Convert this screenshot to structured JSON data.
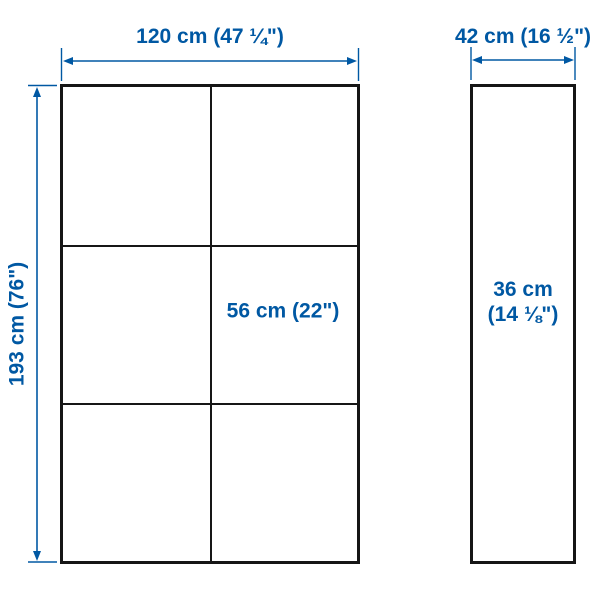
{
  "colors": {
    "dimension_blue": "#0058a3",
    "outline_black": "#161616",
    "background": "#ffffff"
  },
  "diagram": {
    "front_view": {
      "width_label": "120 cm (47 ¼\")",
      "height_label": "193 cm (76\")",
      "compartment_width_label": "56 cm (22\")",
      "grid_columns": 2,
      "grid_rows": 3
    },
    "side_view": {
      "depth_label": "42 cm (16 ½\")",
      "inner_depth_label_line1": "36 cm",
      "inner_depth_label_line2": "(14 ⅛\")"
    }
  }
}
